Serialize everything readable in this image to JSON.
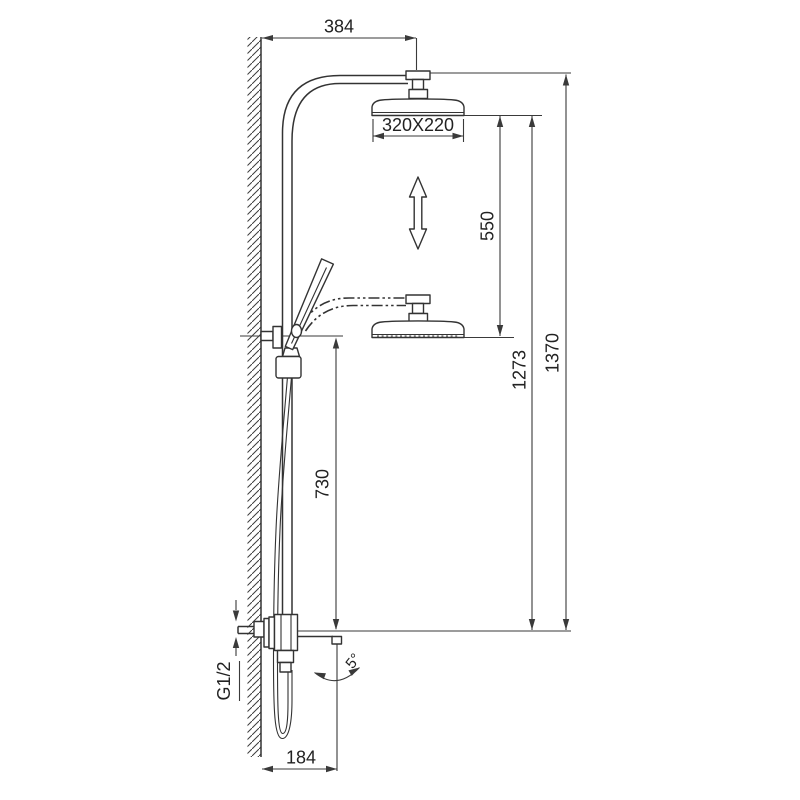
{
  "page": {
    "background": "#ffffff"
  },
  "drawing": {
    "line_color": "#333333",
    "dimension_color": "#3a3a3a",
    "text_color": "#222222",
    "labels": {
      "wall_to_head_center": "384",
      "overhead_shower_size": "320X220",
      "height_adjust_travel": "550",
      "spout_to_slider_bracket": "730",
      "spout_to_lowered_head": "1273",
      "overall_height": "1370",
      "wall_to_spout_tip": "184",
      "inlet_thread": "G1/2",
      "spout_tilt_angle": "5°"
    }
  }
}
